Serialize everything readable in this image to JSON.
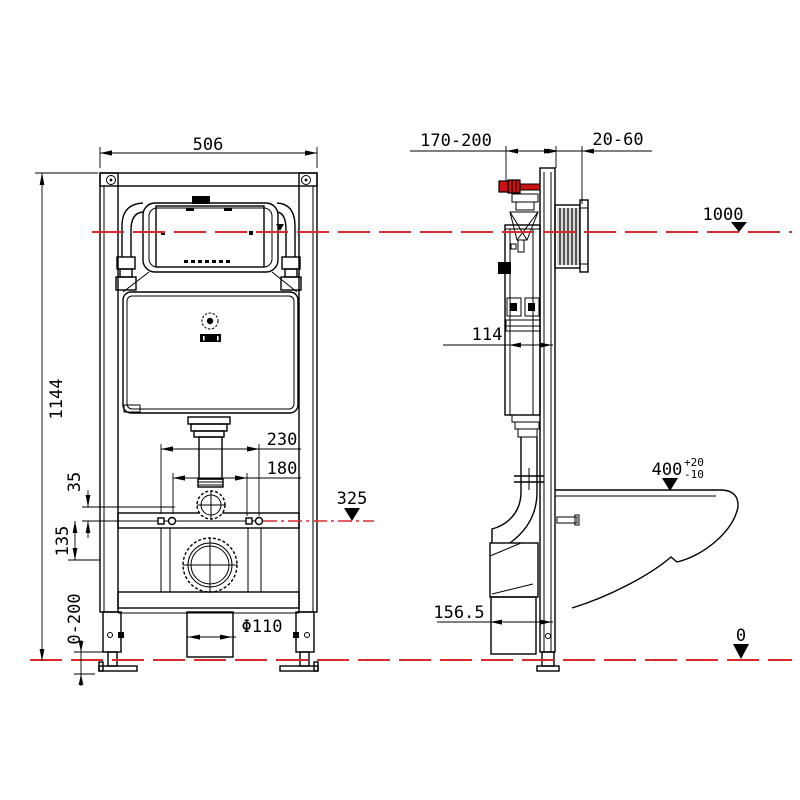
{
  "colors": {
    "line": "#000000",
    "centerline": "#d92b2b",
    "inlet_pipe": "#cc1111"
  },
  "front_view": {
    "dim_frame_width": "506",
    "dim_frame_height": "1144",
    "dim_fixing_outer": "230",
    "dim_fixing_inner": "180",
    "dim_flush_offset": "35",
    "dim_drain_offset": "135",
    "dim_foot_adjust": "0-200",
    "dim_drain_pipe": "Φ110",
    "level_fixing": "325"
  },
  "side_view": {
    "dim_inlet_depth": "170-200",
    "dim_plate_depth": "20-60",
    "level_top": "1000",
    "dim_tank_depth": "114",
    "dim_bowl_height": "400",
    "bowl_tol_plus": "+20",
    "bowl_tol_minus": "-10",
    "dim_outlet_offset": "156.5",
    "level_floor": "0"
  }
}
